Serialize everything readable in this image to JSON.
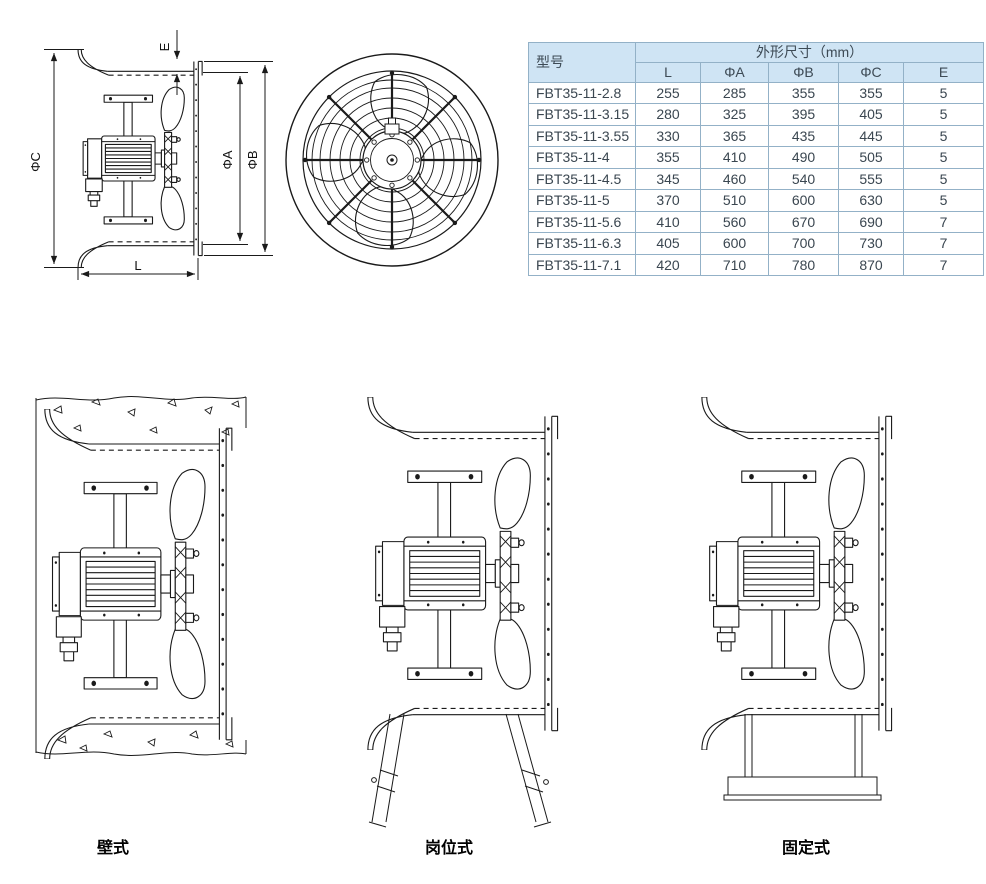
{
  "table": {
    "header": {
      "model_col": "型号",
      "dims_col": "外形尺寸（mm）",
      "sub_cols": [
        "L",
        "ΦA",
        "ΦB",
        "ΦC",
        "E"
      ]
    },
    "rows": [
      [
        "FBT35-11-2.8",
        "255",
        "285",
        "355",
        "355",
        "5"
      ],
      [
        "FBT35-11-3.15",
        "280",
        "325",
        "395",
        "405",
        "5"
      ],
      [
        "FBT35-11-3.55",
        "330",
        "365",
        "435",
        "445",
        "5"
      ],
      [
        "FBT35-11-4",
        "355",
        "410",
        "490",
        "505",
        "5"
      ],
      [
        "FBT35-11-4.5",
        "345",
        "460",
        "540",
        "555",
        "5"
      ],
      [
        "FBT35-11-5",
        "370",
        "510",
        "600",
        "630",
        "5"
      ],
      [
        "FBT35-11-5.6",
        "410",
        "560",
        "670",
        "690",
        "7"
      ],
      [
        "FBT35-11-6.3",
        "405",
        "600",
        "700",
        "730",
        "7"
      ],
      [
        "FBT35-11-7.1",
        "420",
        "710",
        "780",
        "870",
        "7"
      ]
    ],
    "colors": {
      "header_bg": "#cfe4f4",
      "border": "#93b1c7",
      "outer_border": "#6e95b4",
      "text": "#3c4852"
    }
  },
  "side_view": {
    "labels": {
      "phi_c": "ΦC",
      "e": "E",
      "phi_a": "ΦA",
      "phi_b": "ΦB",
      "l": "L"
    }
  },
  "installation_types": [
    {
      "label": "壁式"
    },
    {
      "label": "岗位式"
    },
    {
      "label": "固定式"
    }
  ],
  "drawing": {
    "line_color": "#1a1a1a"
  }
}
